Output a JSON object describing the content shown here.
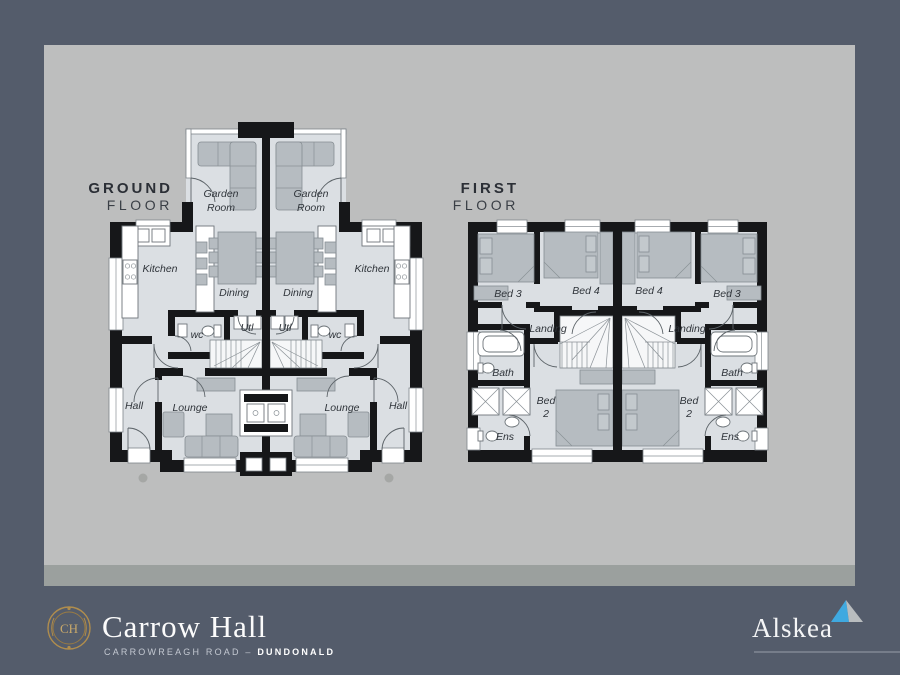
{
  "colors": {
    "background_navy": "#545c6b",
    "panel_gray": "#bdbebe",
    "room_fill": "#dbdfe3",
    "wall_black": "#161719",
    "crest_gold": "#b08d4d",
    "alskea_blue": "#3fa9e0",
    "alskea_gray": "#b9bdbf"
  },
  "plans": {
    "ground": {
      "title_bold": "GROUND",
      "title_light": "FLOOR",
      "labels": {
        "garden1": "Garden",
        "garden2": "Room",
        "kitchen": "Kitchen",
        "dining": "Dining",
        "wc": "wc",
        "utl": "Utl",
        "hall": "Hall",
        "lounge": "Lounge"
      }
    },
    "first": {
      "title_bold": "FIRST",
      "title_light": "FLOOR",
      "labels": {
        "bed3": "Bed 3",
        "bed4": "Bed 4",
        "landing": "Landing",
        "bath": "Bath",
        "ens": "Ens",
        "bed2a": "Bed",
        "bed2b": "2"
      }
    }
  },
  "footer": {
    "monogram": "CH",
    "brand": "Carrow Hall",
    "address_road": "CARROWREAGH ROAD",
    "address_sep": "–",
    "address_town": "DUNDONALD",
    "developer": "Alskea"
  }
}
